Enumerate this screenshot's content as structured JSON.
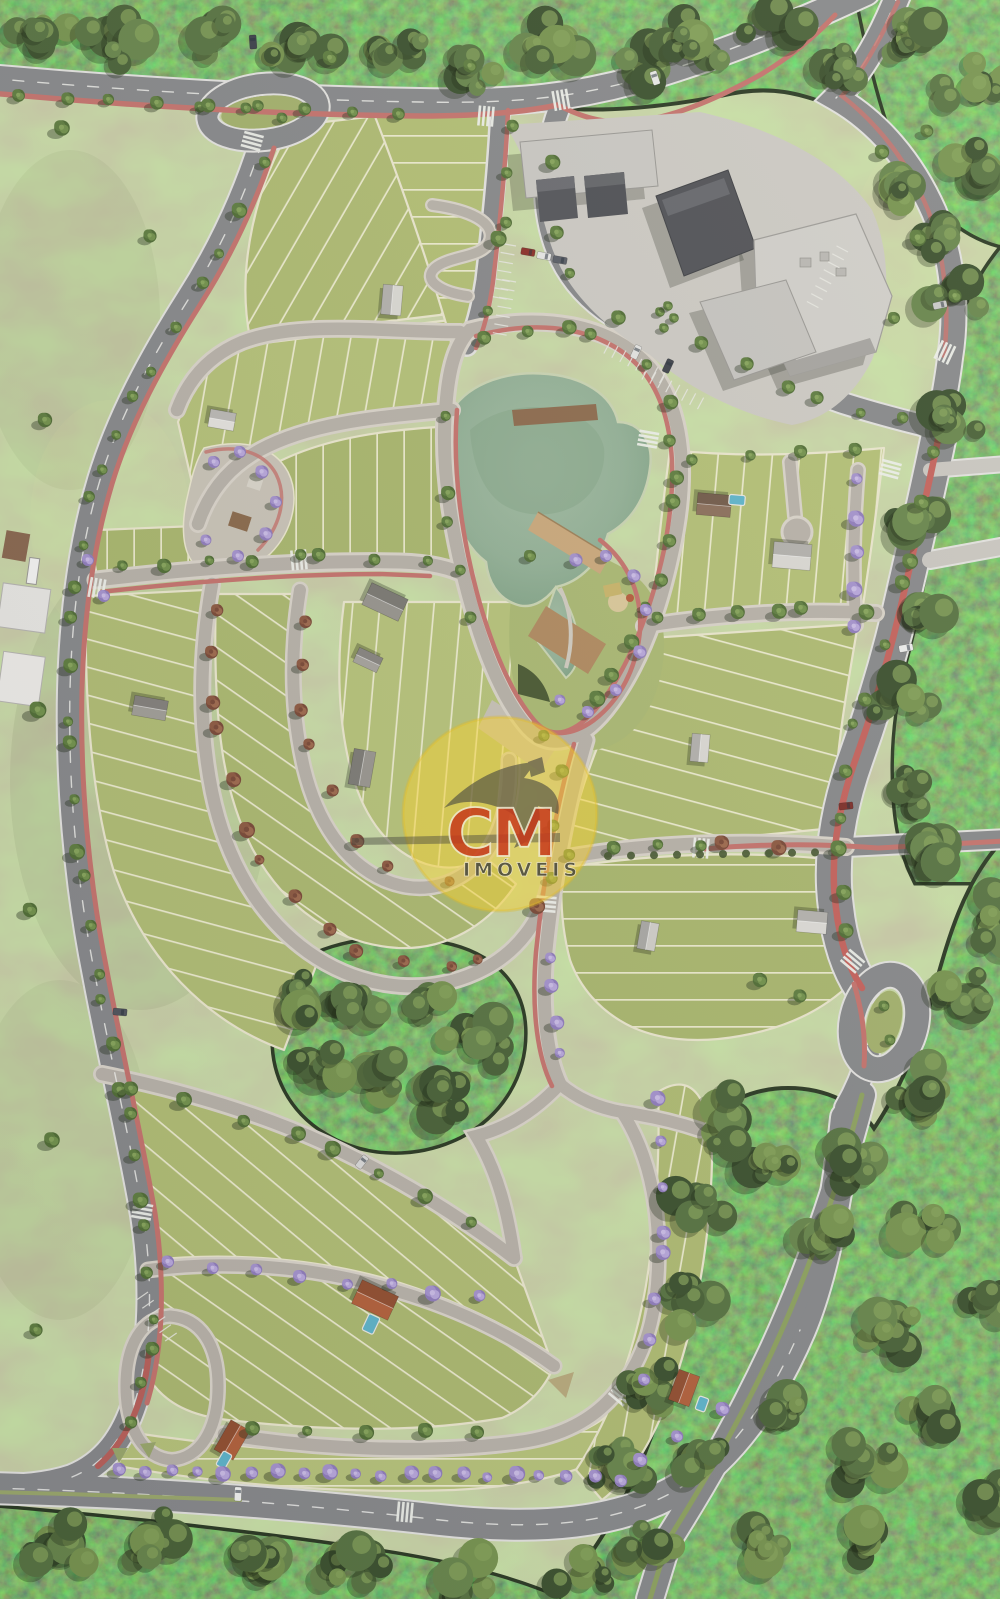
{
  "image": {
    "description": "Aerial 3D rendering of a residential land-development masterplan with curved tree-lined streets, subdivided green lots, a central lake and park, a commercial center, perimeter avenues with red bike paths and preserved woodland around the edges",
    "width_px": 1000,
    "height_px": 1599
  },
  "watermark": {
    "brand": "CM",
    "subtitle": "IMÓVEIS",
    "badge_color": "#f2cf35",
    "brand_color": "#c53a1d",
    "subtitle_color": "#4b4b40"
  },
  "palette": {
    "field_grass": "#9aa76c",
    "lot_grass": "#b0bd76",
    "lot_line": "#ece8cf",
    "forest": "#4a5e38",
    "asphalt": "#87888a",
    "paver_street": "#b9b3aa",
    "curb": "#e2e1de",
    "bike_path_red": "#c4736d",
    "lake_water": "#93b096",
    "wood_deck": "#b18a5f",
    "roof_dark": "#4e4f52",
    "roof_light": "#cccac6",
    "roof_terracotta": "#b2603c",
    "pool_blue": "#5fb3c9",
    "ipe_purple": "#af97d4"
  }
}
